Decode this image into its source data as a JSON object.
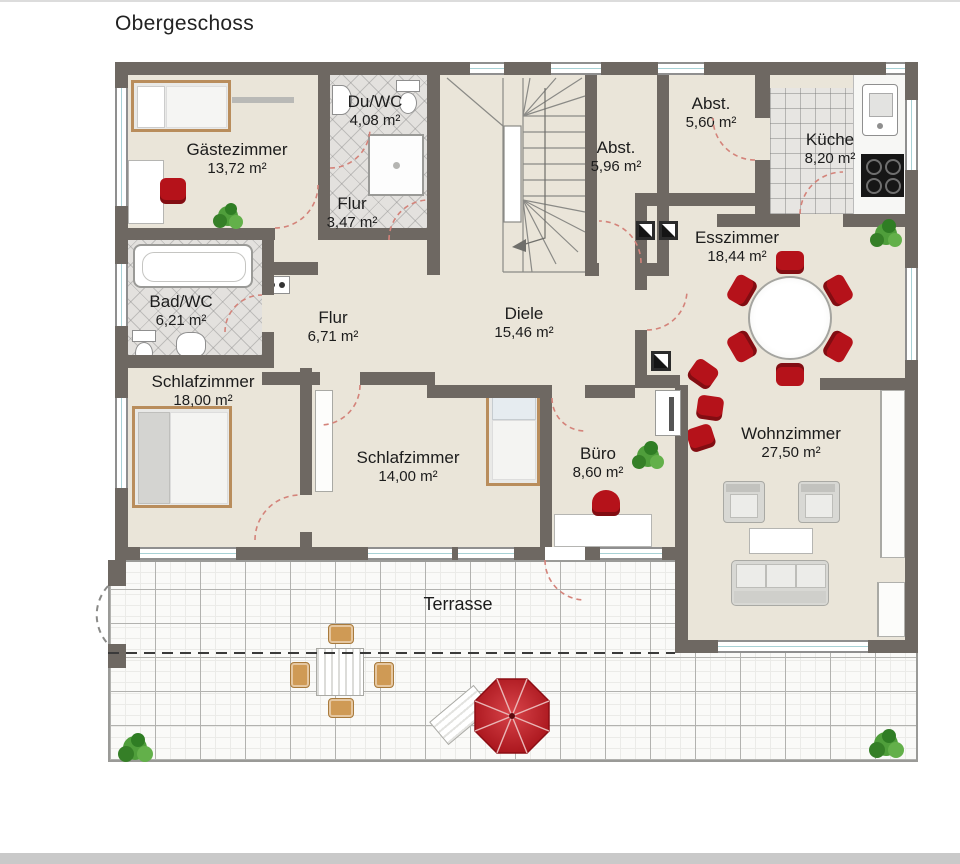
{
  "title": "Obergeschoss",
  "rooms": [
    {
      "name": "Gästezimmer",
      "area": "13,72 m²"
    },
    {
      "name": "Du/WC",
      "area": "4,08 m²"
    },
    {
      "name": "Flur",
      "area": "3,47 m²"
    },
    {
      "name": "Abst.",
      "area": "5,96 m²"
    },
    {
      "name": "Abst.",
      "area": "5,60 m²"
    },
    {
      "name": "Küche",
      "area": "8,20 m²"
    },
    {
      "name": "Esszimmer",
      "area": "18,44 m²"
    },
    {
      "name": "Bad/WC",
      "area": "6,21 m²"
    },
    {
      "name": "Flur",
      "area": "6,71 m²"
    },
    {
      "name": "Diele",
      "area": "15,46 m²"
    },
    {
      "name": "Schlafzimmer",
      "area": "18,00 m²"
    },
    {
      "name": "Schlafzimmer",
      "area": "14,00 m²"
    },
    {
      "name": "Büro",
      "area": "8,60 m²"
    },
    {
      "name": "Wohnzimmer",
      "area": "27,50 m²"
    }
  ],
  "outdoor": {
    "terrace_label": "Terrasse"
  },
  "colors": {
    "wall": "#6e6862",
    "floor_beige": "#eae5d9",
    "accent_red": "#b5121a",
    "wood_tan": "#b98d5c",
    "plant_green": "#4f9e3b",
    "window_glass": "#a8d2d6",
    "door_arc_red": "#d4837a"
  }
}
